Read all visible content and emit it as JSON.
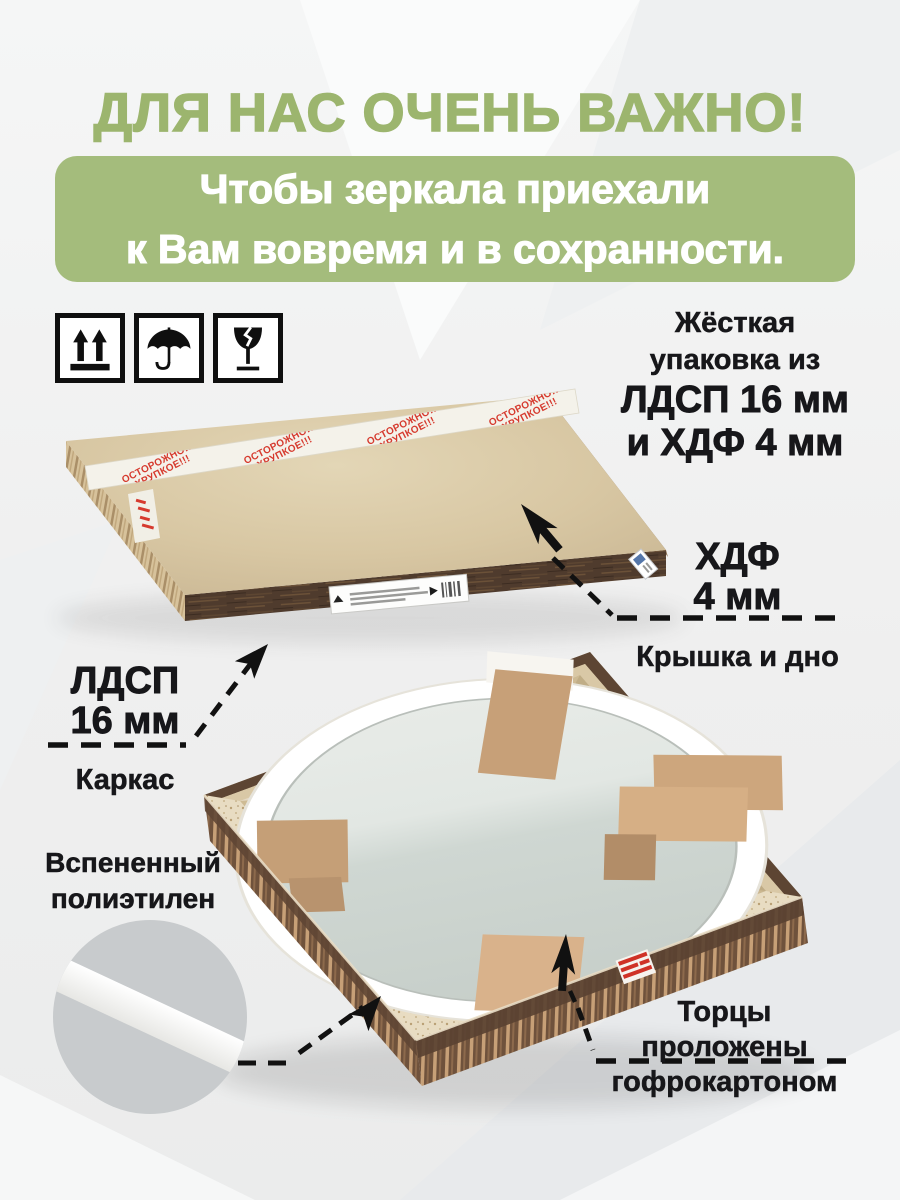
{
  "heading": "ДЛЯ НАС ОЧЕНЬ ВАЖНО!",
  "banner": {
    "line1": "Чтобы зеркала приехали",
    "line2": "к Вам вовремя и в сохранности."
  },
  "handling_icons": [
    {
      "name": "this-side-up-icon"
    },
    {
      "name": "keep-dry-icon"
    },
    {
      "name": "fragile-icon"
    }
  ],
  "packaging_note": {
    "line1": "Жёсткая",
    "line2": "упаковка из",
    "line3": "ЛДСП 16 мм",
    "line4": "и ХДФ 4 мм"
  },
  "tape": {
    "line1": "ОСТОРОЖНО!!!",
    "line2": "ХРУПКОЕ!!!"
  },
  "callouts": {
    "hdf": {
      "title1": "ХДФ",
      "title2": "4 мм",
      "caption": "Крышка и дно"
    },
    "ldsp": {
      "title1": "ЛДСП",
      "title2": "16 мм",
      "caption": "Каркас"
    },
    "foam": {
      "line1": "Вспененный",
      "line2": "полиэтилен"
    },
    "edges": {
      "line1": "Торцы",
      "line2": "проложены",
      "line3": "гофрокартоном"
    }
  },
  "colors": {
    "accent_green_heading": "#9cb56e",
    "accent_green_banner": "#a4bc7c",
    "tape_red": "#d63a2e",
    "kraft_board": "#d8c7a3",
    "walnut_edge": "#5a4232",
    "text_dark": "#17171a"
  }
}
